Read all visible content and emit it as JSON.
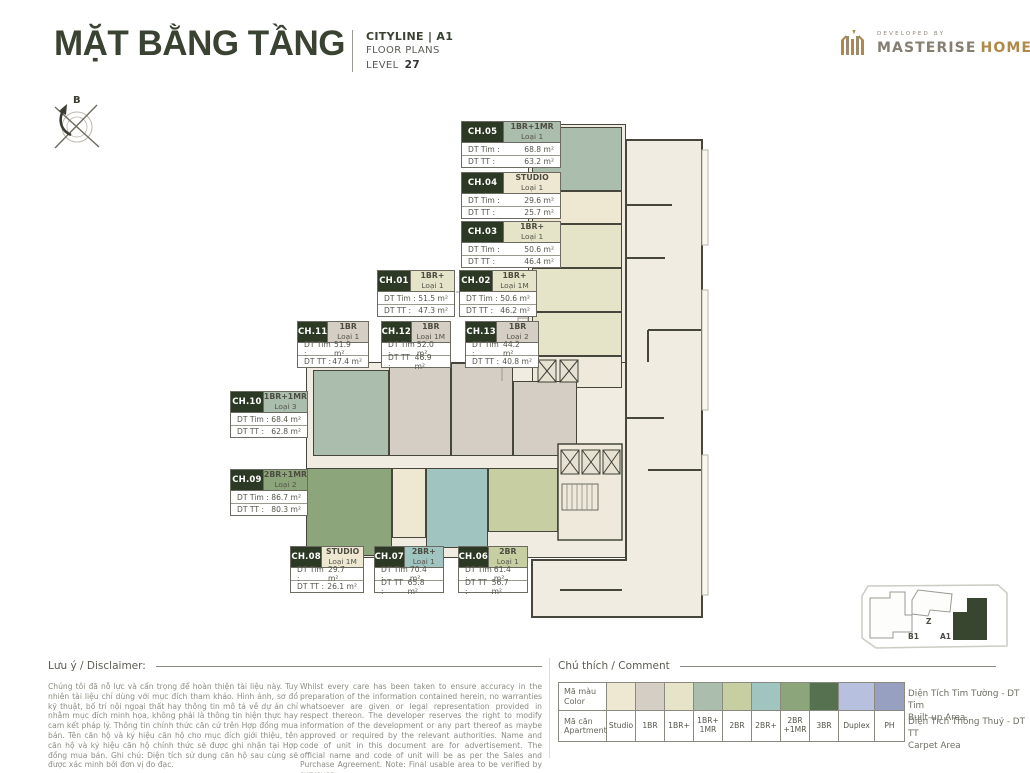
{
  "header": {
    "title": "MẶT BẰNG TẦNG",
    "project": "CITYLINE | A1",
    "plans": "FLOOR PLANS",
    "level_label": "LEVEL",
    "level_value": "27",
    "developed_by": "DEVELOPED BY",
    "brand_primary": "MASTERISE",
    "brand_secondary": "HOMES"
  },
  "compass": {
    "north_label": "B"
  },
  "unit_fields": {
    "tim_label": "DT Tim :",
    "tt_label": "DT TT :"
  },
  "units": [
    {
      "id": "CH.05",
      "type": "1BR+1MR",
      "variant": "Loại 1",
      "tim": "68.8 m²",
      "tt": "63.2 m²",
      "color": "#abbead"
    },
    {
      "id": "CH.04",
      "type": "STUDIO",
      "variant": "Loại 1",
      "tim": "29.6 m²",
      "tt": "25.7 m²",
      "color": "#eee7d1"
    },
    {
      "id": "CH.03",
      "type": "1BR+",
      "variant": "Loại 1",
      "tim": "50.6 m²",
      "tt": "46.4 m²",
      "color": "#e5e4c8"
    },
    {
      "id": "CH.01",
      "type": "1BR+",
      "variant": "Loại 1",
      "tim": "51.5 m²",
      "tt": "47.3 m²",
      "color": "#e5e4c8"
    },
    {
      "id": "CH.02",
      "type": "1BR+",
      "variant": "Loại 1M",
      "tim": "50.6 m²",
      "tt": "46.2 m²",
      "color": "#e5e4c8"
    },
    {
      "id": "CH.11",
      "type": "1BR",
      "variant": "Loại 1",
      "tim": "51.9 m²",
      "tt": "47.4 m²",
      "color": "#d4cec4"
    },
    {
      "id": "CH.12",
      "type": "1BR",
      "variant": "Loại 1M",
      "tim": "52.0 m²",
      "tt": "46.9 m²",
      "color": "#d4cec4"
    },
    {
      "id": "CH.13",
      "type": "1BR",
      "variant": "Loại 2",
      "tim": "44.2 m²",
      "tt": "40.8 m²",
      "color": "#d4cec4"
    },
    {
      "id": "CH.10",
      "type": "1BR+1MR",
      "variant": "Loại 3",
      "tim": "68.4 m²",
      "tt": "62.8 m²",
      "color": "#abbead"
    },
    {
      "id": "CH.09",
      "type": "2BR+1MR",
      "variant": "Loại 2",
      "tim": "86.7 m²",
      "tt": "80.3 m²",
      "color": "#8da57b"
    },
    {
      "id": "CH.08",
      "type": "STUDIO",
      "variant": "Loại 1M",
      "tim": "29.7 m²",
      "tt": "26.1 m²",
      "color": "#eee7d1"
    },
    {
      "id": "CH.07",
      "type": "2BR+",
      "variant": "Loại 1",
      "tim": "70.4 m²",
      "tt": "65.8 m²",
      "color": "#a0c5c1"
    },
    {
      "id": "CH.06",
      "type": "2BR",
      "variant": "Loại 1",
      "tim": "61.4 m²",
      "tt": "56.7 m²",
      "color": "#c7cfa2"
    }
  ],
  "keyplan": {
    "z": "Z",
    "b1": "B1",
    "a1": "A1",
    "highlight": "A1",
    "highlight_color": "#39462f"
  },
  "disclaimer": {
    "heading": "Lưu ý / Disclaimer:",
    "vi": "Chúng tôi đã nỗ lực và cẩn trọng để hoàn thiện tài liệu này. Tuy nhiên tài liệu chỉ dùng với mục đích tham khảo. Hình ảnh, sơ đồ kỹ thuật, bố trí nội ngoại thất hay thông tin mô tả về dự án chỉ nhằm mục đích minh họa, không phải là thông tin hiện thực hay cam kết pháp lý. Thông tin chính thức căn cứ trên Hợp đồng mua bán. Tên căn hộ và ký hiệu căn hộ cho mục đích giới thiệu, tên căn hộ và ký hiệu căn hộ chính thức sẽ được ghi nhận tại Hợp đồng mua bán. Ghi chú: Diện tích sử dụng căn hộ sau cùng sẽ được xác minh bởi đơn vị đo đạc.",
    "en": "Whilst every care has been taken to ensure accuracy in the preparation of the information contained herein, no warranties whatsoever are given or legal representation provided in respect thereon. The developer reserves the right to modify information of the development or any part thereof as maybe approved or required by the relevant authorities. Name and code of unit in this document are for advertisement. The official name and code of unit will be as per the Sales and Purchase Agreement. Note: Final usable area to be verified by surveyor."
  },
  "legend": {
    "heading": "Chú thích / Comment",
    "row1_l1": "Mã màu",
    "row1_l2": "Color",
    "row2_l1": "Mã căn",
    "row2_l2": "Apartment",
    "items": [
      {
        "label": "Studio",
        "color": "#eee7d1"
      },
      {
        "label": "1BR",
        "color": "#d4cec4"
      },
      {
        "label": "1BR+",
        "color": "#e5e4c8"
      },
      {
        "label": "1BR+\n1MR",
        "color": "#abbead"
      },
      {
        "label": "2BR",
        "color": "#c7cfa2"
      },
      {
        "label": "2BR+",
        "color": "#a0c5c1"
      },
      {
        "label": "2BR\n+1MR",
        "color": "#8da57b"
      },
      {
        "label": "3BR",
        "color": "#55714f"
      },
      {
        "label": "Duplex",
        "color": "#b7c0de"
      },
      {
        "label": "PH",
        "color": "#97a0c0"
      }
    ],
    "notes": [
      {
        "line1": "Diện Tích Tim Tường - DT Tim",
        "line2": "Built-up Area"
      },
      {
        "line1": "Diện Tích Thông Thuỷ - DT TT",
        "line2": "Carpet Area"
      }
    ]
  }
}
